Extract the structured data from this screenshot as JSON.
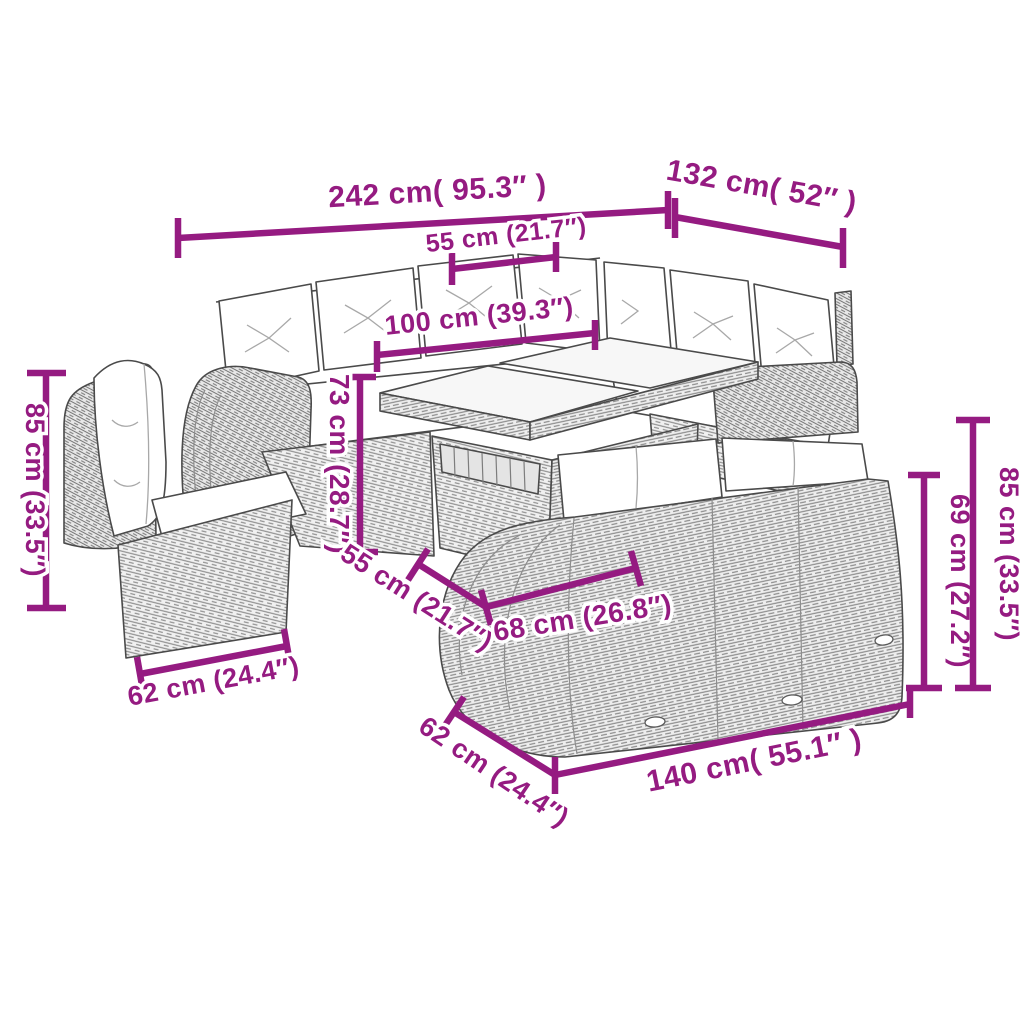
{
  "colors": {
    "dimension_accent": "#951b81",
    "line_art": "#4a4a4a",
    "rattan_fill": "#f0f0f0",
    "cushion_fill": "#ffffff",
    "glass_fill": "#f7f7f7",
    "background": "#ffffff"
  },
  "dimensions": {
    "d242": "242 cm( 95.3″ )",
    "d132": "132 cm( 52″ )",
    "d55_top": "55 cm (21.7″)",
    "d100": "100 cm (39.3″)",
    "d85_left": "85 cm (33.5″)",
    "d73": "73 cm (28.7″)",
    "d55_diag": "55 cm (21.7″)",
    "d68": "68 cm (26.8″)",
    "d62_left": "62 cm (24.4″)",
    "d62_diag": "62 cm (24.4″)",
    "d140": "140 cm( 55.1″ )",
    "d69": "69 cm (27.2″)",
    "d85_right": "85 cm (33.5″)"
  }
}
